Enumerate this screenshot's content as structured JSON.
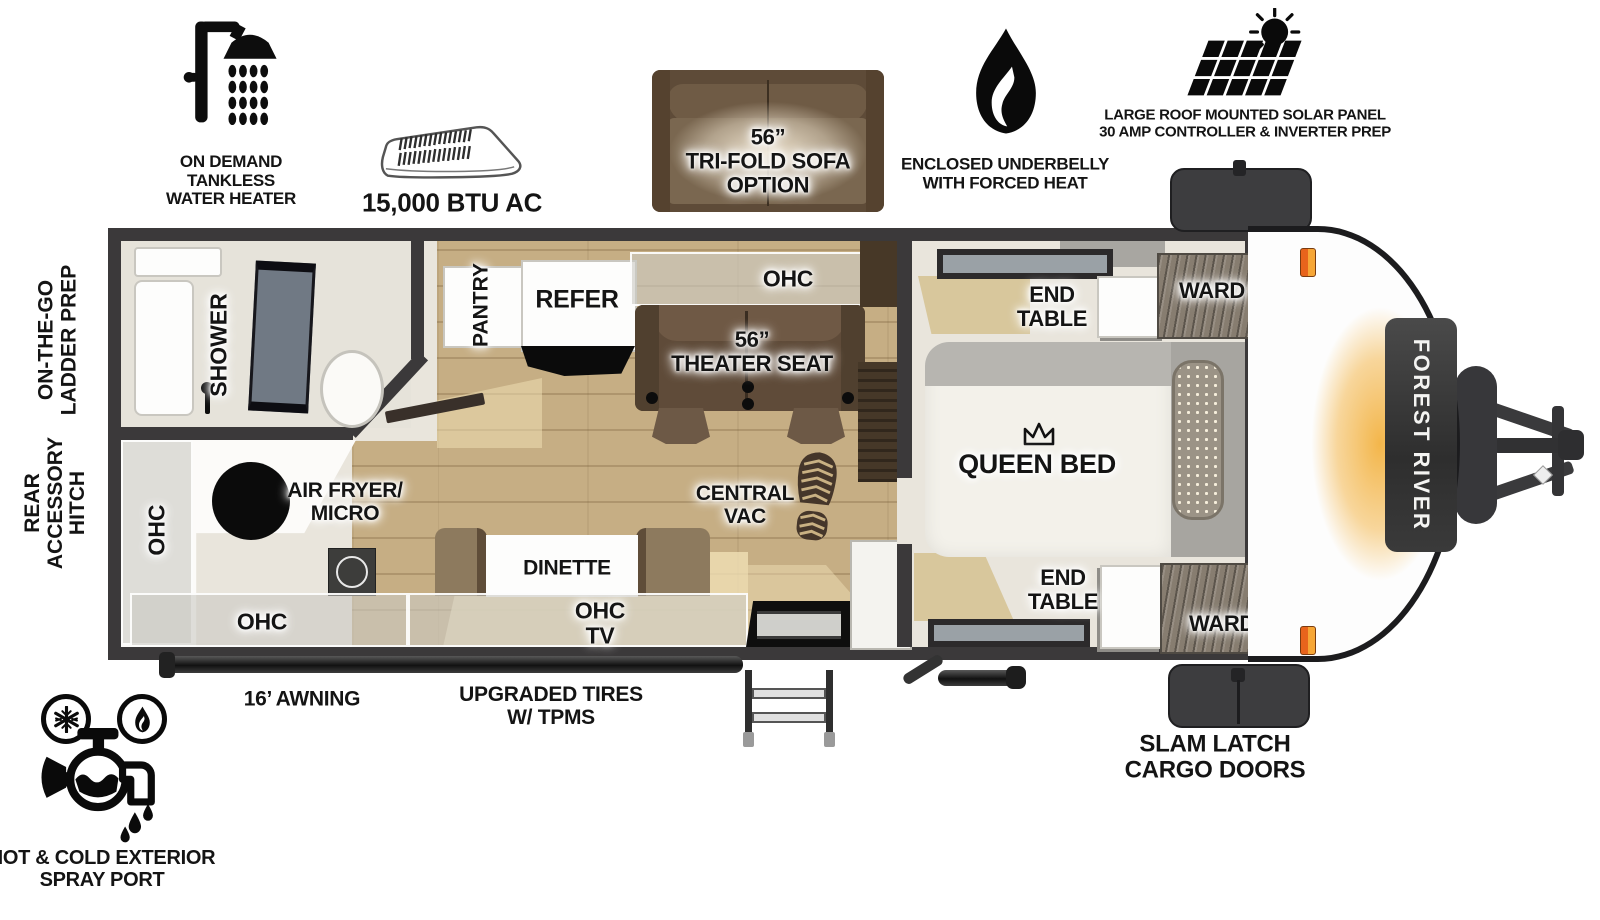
{
  "brand": {
    "logo_text": "FOREST RIVER"
  },
  "top_features": {
    "water_heater": {
      "icon": "shower-icon",
      "line1": "ON DEMAND",
      "line2": "TANKLESS",
      "line3": "WATER HEATER"
    },
    "ac": {
      "icon": "ac-unit-icon",
      "label": "15,000 BTU AC"
    },
    "sofa_option": {
      "line1": "56”",
      "line2": "TRI-FOLD SOFA",
      "line3": "OPTION"
    },
    "underbelly": {
      "icon": "flame-icon",
      "line1": "ENCLOSED UNDERBELLY",
      "line2": "WITH FORCED HEAT"
    },
    "solar": {
      "icon": "solar-panel-icon",
      "line1": "LARGE ROOF MOUNTED SOLAR PANEL",
      "line2": "30 AMP CONTROLLER & INVERTER PREP"
    }
  },
  "side_labels": {
    "ladder": {
      "line1": "ON-THE-GO",
      "line2": "LADDER PREP"
    },
    "rear_hitch": {
      "line1": "REAR",
      "line2": "ACCESSORY",
      "line3": "HITCH"
    }
  },
  "floorplan": {
    "shower": "SHOWER",
    "pantry": "PANTRY",
    "refer": "REFER",
    "ohc_top": "OHC",
    "ohc_left": "OHC",
    "ohc_bottom": "OHC",
    "theater": {
      "line1": "56”",
      "line2": "THEATER SEAT"
    },
    "central_vac": {
      "line1": "CENTRAL",
      "line2": "VAC"
    },
    "air_fryer": {
      "line1": "AIR FRYER/",
      "line2": "MICRO"
    },
    "dinette": "DINETTE",
    "ohc_tv": {
      "line1": "OHC",
      "line2": "TV"
    },
    "queen_bed": "QUEEN BED",
    "end_table_front": {
      "line1": "END",
      "line2": "TABLE"
    },
    "end_table_rear": {
      "line1": "END",
      "line2": "TABLE"
    },
    "ward_top": "WARD",
    "ward_bottom": "WARD"
  },
  "bottom_features": {
    "awning": "16’ AWNING",
    "tires": {
      "line1": "UPGRADED TIRES",
      "line2": "W/ TPMS"
    },
    "spray_port": {
      "line1": "HOT & COLD EXTERIOR",
      "line2": "SPRAY PORT"
    },
    "cargo_doors": {
      "line1": "SLAM LATCH",
      "line2": "CARGO DOORS"
    }
  },
  "colors": {
    "wall": "#3b393a",
    "floor_wood": "#c6ae84",
    "interior": "#e9e5dc",
    "seat_brown": "#5f4b39",
    "cap_glow": "#f3b64b",
    "marker_light": "#e8641c"
  }
}
